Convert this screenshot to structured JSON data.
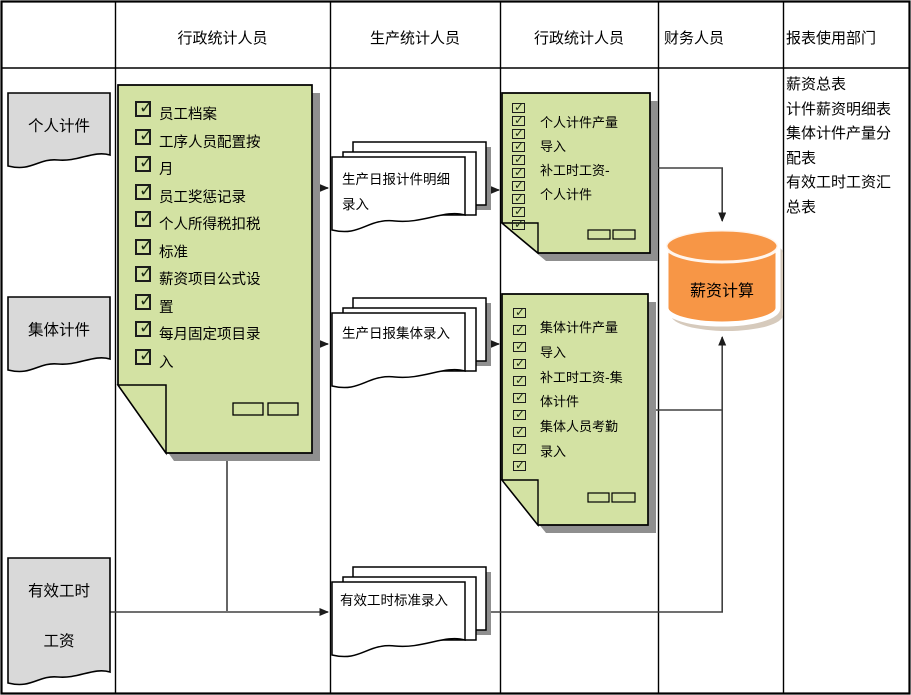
{
  "colors": {
    "green": "#d3e2a3",
    "gray_doc": "#d9d9d9",
    "orange": "#f79646",
    "shadow": "#8f8f8f"
  },
  "icons": {
    "check": "✓"
  },
  "header": {
    "lanes": [
      "行政统计人员",
      "生产统计人员",
      "行政统计人员",
      "财务人员",
      "报表使用部门"
    ]
  },
  "left_labels": {
    "personal": "个人计件",
    "collective": "集体计件",
    "effective_line1": "有效工时",
    "effective_line2": "工资"
  },
  "admin_setup_box": {
    "lines": [
      "员工档案",
      "工序人员配置按",
      "月",
      "员工奖惩记录",
      "个人所得税扣税",
      "标准",
      "薪资项目公式设",
      "置",
      "每月固定项目录",
      "入"
    ]
  },
  "documents": {
    "piece_detail": {
      "lines": [
        "生产日报计件明细",
        "录入"
      ]
    },
    "collective": {
      "lines": [
        "生产日报集体录入"
      ]
    },
    "effective_hours": {
      "lines": [
        "有效工时标准录入"
      ]
    }
  },
  "entry_box_personal": {
    "lines": [
      "个人计件产量",
      "导入",
      "补工时工资-",
      "个人计件"
    ]
  },
  "entry_box_collective": {
    "lines": [
      "集体计件产量",
      "导入",
      "补工时工资-集",
      "体计件",
      "集体人员考勤",
      "录入"
    ]
  },
  "database": {
    "label": "薪资计算"
  },
  "reports": {
    "lines": [
      "薪资总表",
      "计件薪资明细表",
      "集体计件产量分",
      "配表",
      "有效工时工资汇",
      "总表"
    ]
  }
}
